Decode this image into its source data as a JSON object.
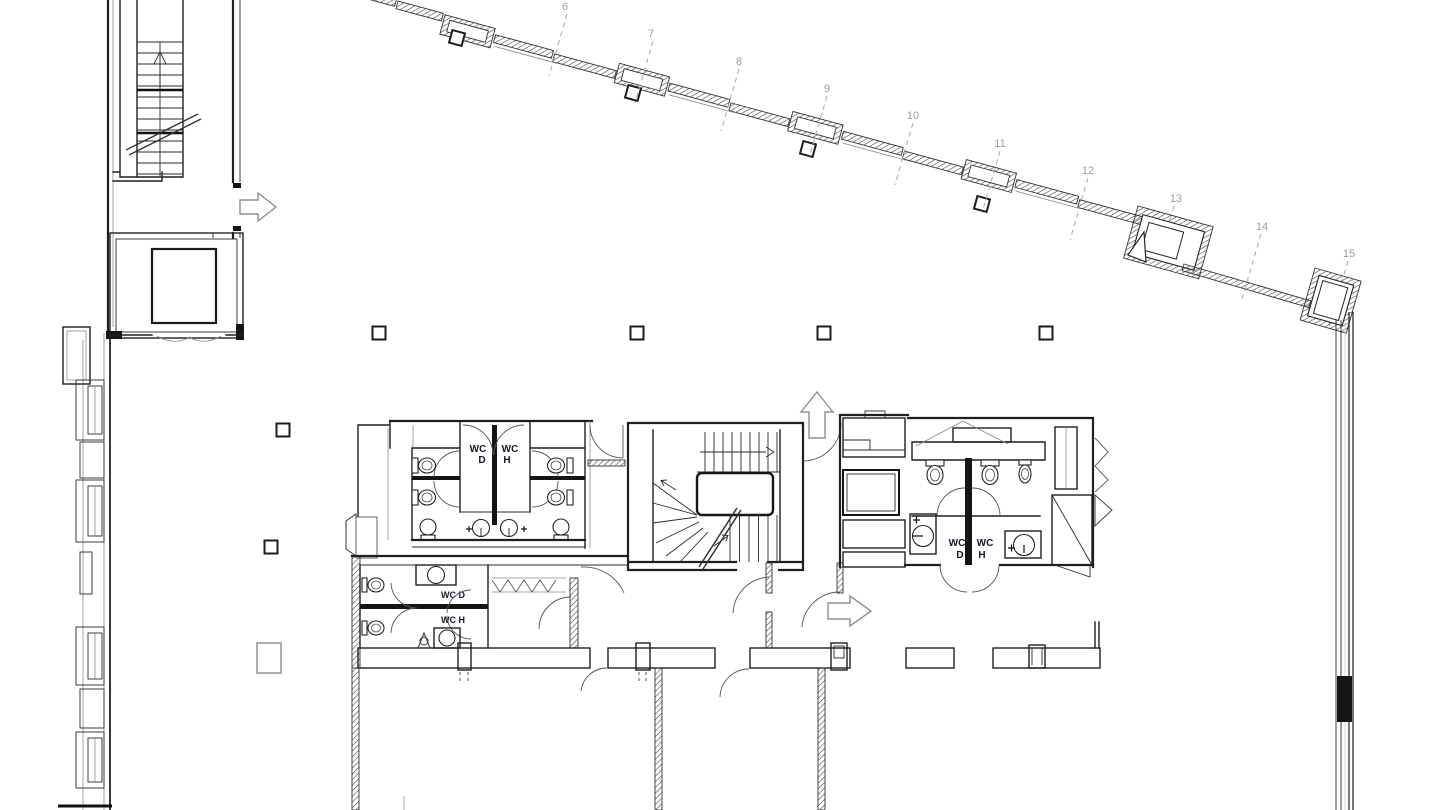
{
  "colors": {
    "background": "#ffffff",
    "ink": "#1f1f1f",
    "grid_line": "#a8a8a8",
    "grid_label": "#9c9c9c",
    "arrow": "#8f8f8f",
    "wc_label_dark": "#15152e",
    "wc_label_teal": "#2d6f6f"
  },
  "labels": {
    "wc": "WC",
    "women": "D",
    "men": "H",
    "wc_women": "WC D",
    "wc_men": "WC H",
    "grid": [
      "6",
      "7",
      "8",
      "9",
      "10",
      "11",
      "12",
      "13",
      "14",
      "15"
    ]
  },
  "icons": {
    "tower_exit": "exit-arrow-right-icon",
    "core_exit": "exit-arrow-right-icon",
    "core_up": "up-arrow-icon",
    "stair_up_flight": "stair-direction-arrow-icon",
    "stair_tower_up": "stair-direction-arrow-icon"
  }
}
